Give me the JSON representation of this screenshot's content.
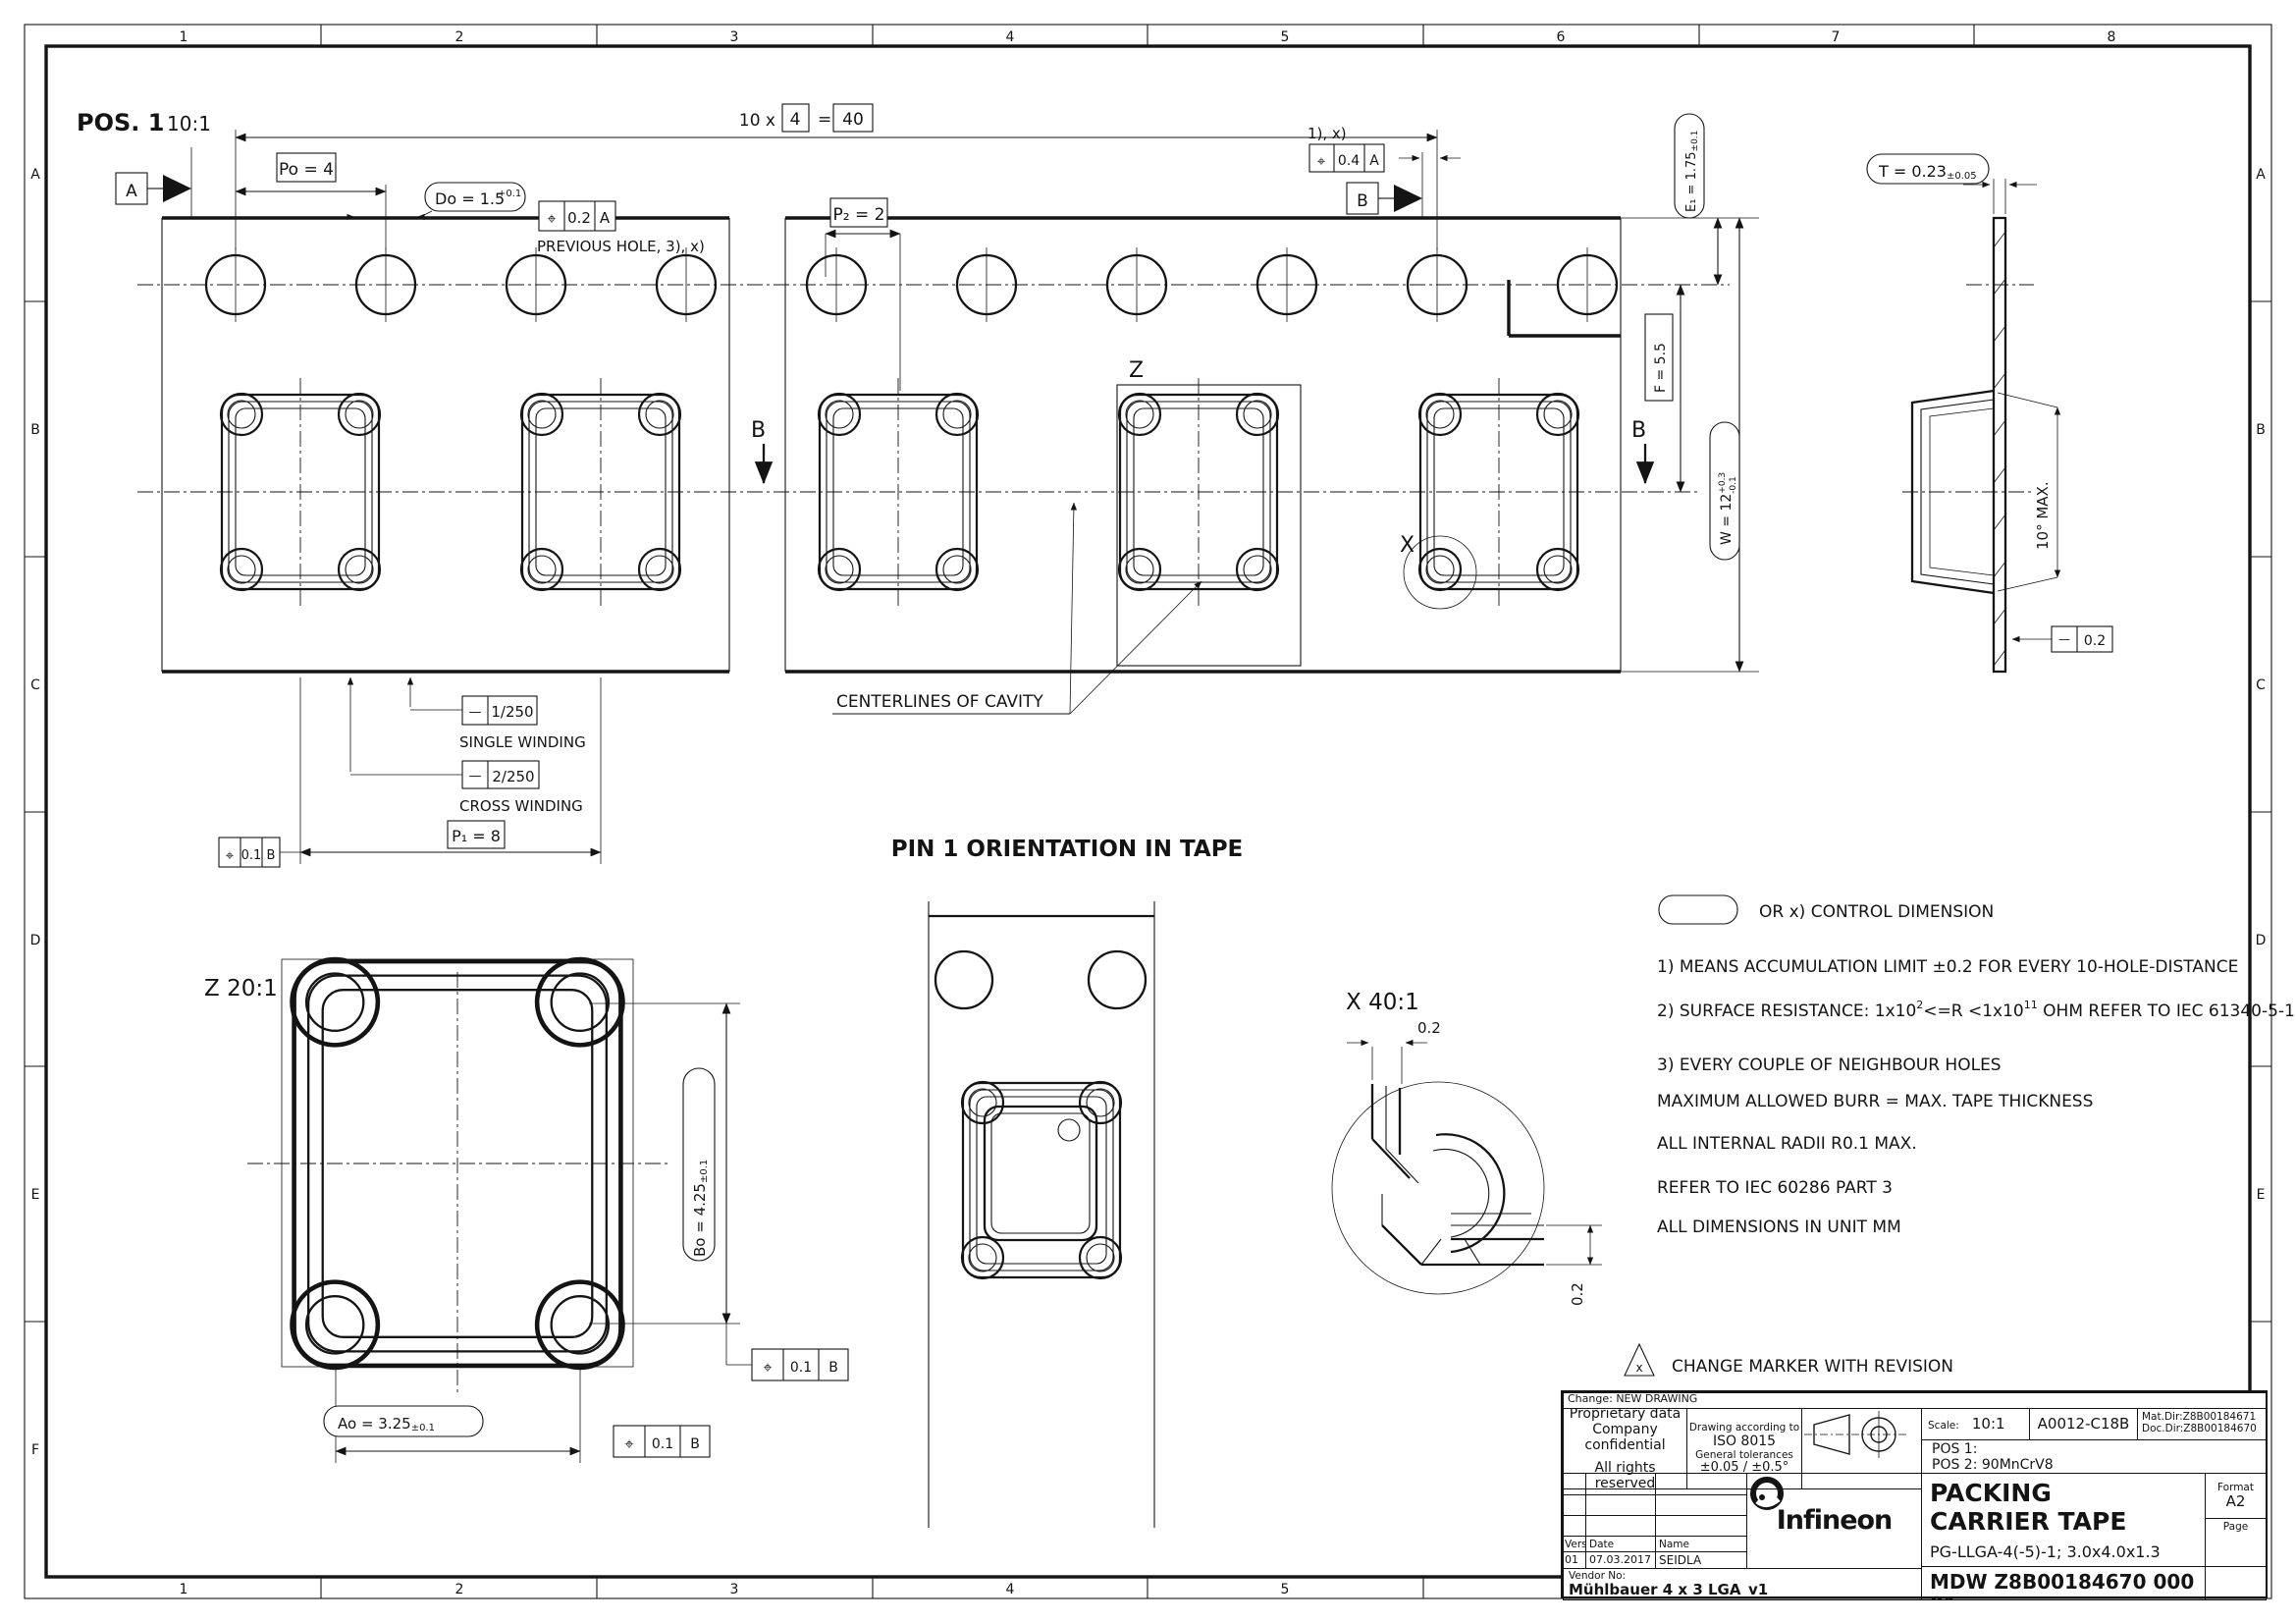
{
  "sheet": {
    "grid_top": [
      "1",
      "2",
      "3",
      "4",
      "5",
      "6",
      "7",
      "8"
    ],
    "grid_bottom": [
      "1",
      "2",
      "3",
      "4",
      "5"
    ],
    "grid_left": [
      "A",
      "B",
      "C",
      "D",
      "E",
      "F"
    ],
    "grid_right": [
      "A",
      "B",
      "C",
      "D",
      "E",
      "F"
    ]
  },
  "pos1": {
    "title": "POS. 1",
    "scale": "10:1",
    "po": "Po = 4",
    "do_val": "Do = 1.5",
    "do_tol": "+0.1",
    "count_prefix": "10 x",
    "count_box": "4",
    "count_eq": "=",
    "count_total": "40",
    "p2": "P₂ = 2",
    "acc_note": "1), x)",
    "prev_hole": "PREVIOUS HOLE, 3), x)",
    "fcf_top_left": {
      "sym": "⌖",
      "val": "0.2",
      "datum": "A"
    },
    "fcf_top_right": {
      "sym": "⌖",
      "val": "0.4",
      "datum": "A"
    },
    "datum_a": "A",
    "datum_b": "B",
    "e1": "E₁ = 1.75",
    "e1_tol": "±0.1",
    "f": "F = 5.5",
    "w": "W = 12",
    "w_up": "+0.3",
    "w_dn": "-0.1",
    "section_b_left": "B",
    "section_b_right": "B",
    "z_ref": "Z",
    "x_ref": "X",
    "centerlines": "CENTERLINES OF CAVITY",
    "fcf_wind1": {
      "sym": "—",
      "val": "1/250",
      "label": "SINGLE WINDING"
    },
    "fcf_wind2": {
      "sym": "—",
      "val": "2/250",
      "label": "CROSS WINDING"
    },
    "p1": "P₁ = 8",
    "fcf_p1": {
      "sym": "⌖",
      "val": "0.1",
      "datum": "B"
    }
  },
  "section": {
    "t": "T = 0.23",
    "t_tol": "±0.05",
    "angle": "10° MAX.",
    "flat": {
      "sym": "—",
      "val": "0.2"
    }
  },
  "z_detail": {
    "title": "Z 20:1",
    "bo": "Bo = 4.25",
    "bo_tol": "±0.1",
    "ao": "Ao = 3.25",
    "ao_tol": "±0.1",
    "fcf1": {
      "sym": "⌖",
      "val": "0.1",
      "datum": "B"
    },
    "fcf2": {
      "sym": "⌖",
      "val": "0.1",
      "datum": "B"
    }
  },
  "pin1": {
    "title": "PIN 1 ORIENTATION IN TAPE"
  },
  "x_detail": {
    "title": "X 40:1",
    "dim_top": "0.2",
    "dim_side": "0.2"
  },
  "notes": {
    "legend": "OR x) CONTROL DIMENSION",
    "n1": "1) MEANS ACCUMULATION LIMIT ±0.2 FOR EVERY 10-HOLE-DISTANCE",
    "n2a": "2) SURFACE RESISTANCE: 1x10",
    "n2sup1": "2",
    "n2b": "<=R <1x10",
    "n2sup2": "11",
    "n2c": " OHM REFER TO IEC 61340-5-1",
    "n3": "3) EVERY COUPLE OF NEIGHBOUR HOLES",
    "n4": "MAXIMUM ALLOWED BURR = MAX. TAPE THICKNESS",
    "n5": "ALL INTERNAL RADII R0.1 MAX.",
    "n6": "REFER TO IEC 60286 PART 3",
    "n7": "ALL DIMENSIONS IN UNIT MM",
    "change_marker_sym": "x",
    "change_marker": "CHANGE MARKER WITH REVISION"
  },
  "title_block": {
    "change": "Change: NEW DRAWING",
    "prop1": "Proprietary data",
    "prop2": "Company confidential",
    "prop3": "All rights reserved",
    "std1": "Drawing according to",
    "std2": "ISO 8015",
    "std3": "General tolerances",
    "std4": "±0.05 / ±0.5°",
    "scale_label": "Scale:",
    "scale": "10:1",
    "code": "A0012-C18B",
    "mat": "Mat.Dir:Z8B00184671",
    "doc": "Doc.Dir:Z8B00184670",
    "pos1": "POS 1:",
    "pos2": "POS 2: 90MnCrV8",
    "logo": "Infineon",
    "title1": "PACKING",
    "title2": "CARRIER TAPE",
    "subtitle": "PG-LLGA-4(-5)-1; 3.0x4.0x1.3",
    "doc_no": "MDW Z8B00184670 000 01",
    "format_label": "Format",
    "format": "A2",
    "page_label": "Page",
    "vers_label": "Vers",
    "date_label": "Date",
    "name_label": "Name",
    "vers": "01",
    "date": "07.03.2017",
    "name": "SEIDLA",
    "vendor_label": "Vendor No:",
    "vendor": "Mühlbauer 4 x 3 LGA_v1"
  }
}
